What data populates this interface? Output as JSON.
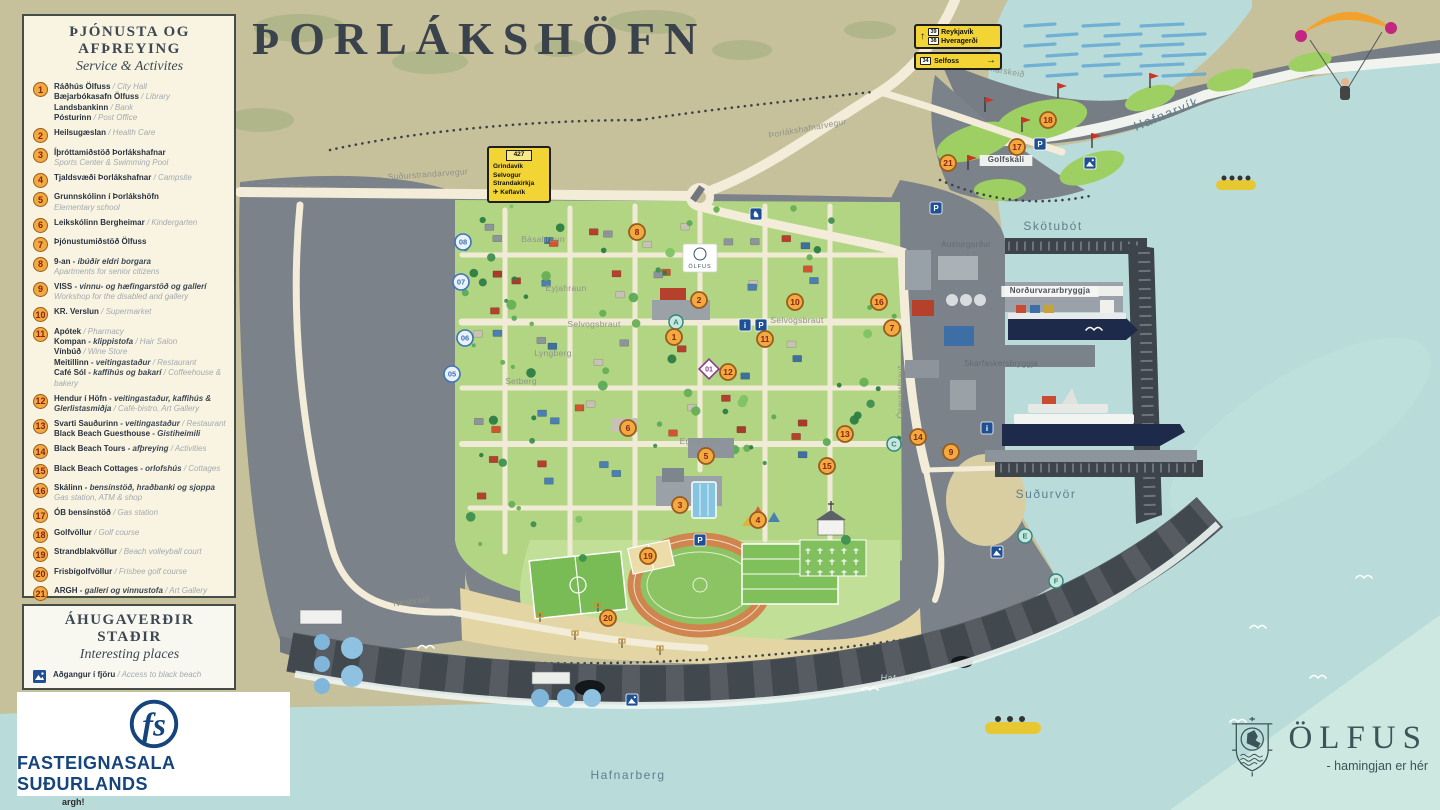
{
  "title": "ÞORLÁKSHÖFN",
  "credit": "argh!",
  "services_legend": {
    "title": "ÞJÓNUSTA OG AFÞREYING",
    "subtitle": "Service & Activites",
    "items": [
      {
        "num": 1,
        "lines": [
          [
            [
              "b",
              "Ráðhús Ölfuss"
            ],
            [
              "g",
              " / City Hall"
            ]
          ],
          [
            [
              "b",
              "Bæjarbókasafn Ölfuss"
            ],
            [
              "g",
              " / Library"
            ]
          ],
          [
            [
              "b",
              "Landsbankinn"
            ],
            [
              "g",
              " / Bank"
            ]
          ],
          [
            [
              "b",
              "Pósturinn"
            ],
            [
              "g",
              " / Post Office"
            ]
          ]
        ]
      },
      {
        "num": 2,
        "lines": [
          [
            [
              "b",
              "Heilsugæslan"
            ],
            [
              "g",
              " / Health Care"
            ]
          ]
        ]
      },
      {
        "num": 3,
        "lines": [
          [
            [
              "b",
              "Íþróttamiðstöð Þorlákshafnar"
            ]
          ],
          [
            [
              "g",
              "Sports Center & Swimming Pool"
            ]
          ]
        ]
      },
      {
        "num": 4,
        "lines": [
          [
            [
              "b",
              "Tjaldsvæði Þorlákshafnar"
            ],
            [
              "g",
              " / Campsite"
            ]
          ]
        ]
      },
      {
        "num": 5,
        "lines": [
          [
            [
              "b",
              "Grunnskólinn í Þorlákshöfn"
            ]
          ],
          [
            [
              "g",
              "Elementary school"
            ]
          ]
        ]
      },
      {
        "num": 6,
        "lines": [
          [
            [
              "b",
              "Leikskólinn Bergheimar"
            ],
            [
              "g",
              " / Kindergarten"
            ]
          ]
        ]
      },
      {
        "num": 7,
        "lines": [
          [
            [
              "b",
              "Þjónustumiðstöð Ölfuss"
            ]
          ]
        ]
      },
      {
        "num": 8,
        "lines": [
          [
            [
              "b",
              "9-an"
            ],
            [
              "i",
              " - íbúðir eldri borgara"
            ]
          ],
          [
            [
              "g",
              "Apartments for senior citizens"
            ]
          ]
        ]
      },
      {
        "num": 9,
        "lines": [
          [
            [
              "b",
              "VISS"
            ],
            [
              "i",
              " - vinnu- og hæfingarstöð og gallerí"
            ],
            [
              "g",
              " Workshop for the disabled and gallery"
            ]
          ]
        ]
      },
      {
        "num": 10,
        "lines": [
          [
            [
              "b",
              "KR. Verslun"
            ],
            [
              "g",
              " / Supermarket"
            ]
          ]
        ]
      },
      {
        "num": 11,
        "lines": [
          [
            [
              "b",
              "Apótek"
            ],
            [
              "g",
              " / Pharmacy"
            ]
          ],
          [
            [
              "b",
              "Kompan"
            ],
            [
              "i",
              " - klippistofa"
            ],
            [
              "g",
              " / Hair Salon"
            ]
          ],
          [
            [
              "b",
              "Vínbúð"
            ],
            [
              "g",
              " / Wine Store"
            ]
          ],
          [
            [
              "b",
              "Meitillinn"
            ],
            [
              "i",
              " - veitingastaður"
            ],
            [
              "g",
              " / Restaurant"
            ]
          ],
          [
            [
              "b",
              "Café Sól"
            ],
            [
              "i",
              " - kaffihús og bakarí"
            ],
            [
              "g",
              " / Coffeehouse & bakery"
            ]
          ]
        ]
      },
      {
        "num": 12,
        "lines": [
          [
            [
              "b",
              "Hendur í Höfn"
            ],
            [
              "i",
              " - veitingastaður, kaffihús & Glerlistasmiðja"
            ],
            [
              "g",
              " / Café-bistro, Art Gallery"
            ]
          ]
        ]
      },
      {
        "num": 13,
        "lines": [
          [
            [
              "b",
              "Svarti Sauðurinn"
            ],
            [
              "i",
              " - veitingastaður"
            ],
            [
              "g",
              " / Restaurant"
            ]
          ],
          [
            [
              "b",
              "Black Beach Guesthouse"
            ],
            [
              "i",
              " - Gistiheimili"
            ]
          ]
        ]
      },
      {
        "num": 14,
        "lines": [
          [
            [
              "b",
              "Black Beach Tours"
            ],
            [
              "i",
              " - afþreying"
            ],
            [
              "g",
              " / Activities"
            ]
          ]
        ]
      },
      {
        "num": 15,
        "lines": [
          [
            [
              "b",
              "Black Beach Cottages"
            ],
            [
              "i",
              " - orlofshús"
            ],
            [
              "g",
              " / Cottages"
            ]
          ]
        ]
      },
      {
        "num": 16,
        "lines": [
          [
            [
              "b",
              "Skálinn"
            ],
            [
              "i",
              " - bensínstöð, hraðbanki og sjoppa"
            ]
          ],
          [
            [
              "g",
              "Gas station, ATM & shop"
            ]
          ]
        ]
      },
      {
        "num": 17,
        "lines": [
          [
            [
              "b",
              "ÓB bensínstöð"
            ],
            [
              "g",
              " / Gas station"
            ]
          ]
        ]
      },
      {
        "num": 18,
        "lines": [
          [
            [
              "b",
              "Golfvöllur"
            ],
            [
              "g",
              " / Golf course"
            ]
          ]
        ]
      },
      {
        "num": 19,
        "lines": [
          [
            [
              "b",
              "Strandblakvöllur"
            ],
            [
              "g",
              " / Beach volleyball court"
            ]
          ]
        ]
      },
      {
        "num": 20,
        "lines": [
          [
            [
              "b",
              "Frisbígolfvöllur"
            ],
            [
              "g",
              " / Frisbee golf course"
            ]
          ]
        ]
      },
      {
        "num": 21,
        "lines": [
          [
            [
              "b",
              "ARGH"
            ],
            [
              "i",
              " - gallerí og vinnustofa"
            ],
            [
              "g",
              " / Art Gallery"
            ]
          ]
        ]
      }
    ]
  },
  "places_legend": {
    "title": "ÁHUGAVERÐIR STAÐIR",
    "subtitle": "Interesting places",
    "items": [
      {
        "icon": "photo-icon",
        "lines": [
          [
            [
              "b",
              "Aðgangur í fjöru"
            ],
            [
              "g",
              " / Access to black beach"
            ]
          ]
        ]
      },
      {
        "icon": "photo-icon",
        "lines": [
          [
            [
              "b",
              "Útsýnisskífa"
            ],
            [
              "g",
              " / Viewpoint"
            ]
          ]
        ]
      }
    ]
  },
  "fs_logo": {
    "monogram": "fs",
    "name": "FASTEIGNASALA SUÐURLANDS"
  },
  "olfus_logo": {
    "name": "ÖLFUS",
    "tagline": "- hamingjan er hér"
  },
  "road_signs": {
    "junction": {
      "route": "427",
      "destinations": [
        "Grindavík",
        "Selvogur",
        "Strandakirkja",
        "✈ Keflavík"
      ]
    },
    "north_a": {
      "arrow": "↑",
      "rows": [
        {
          "badge": "39",
          "text": "Reykjavík"
        },
        {
          "badge": "38",
          "text": "Hveragerði"
        }
      ]
    },
    "north_b": {
      "badge": "34",
      "text": "Selfoss",
      "arrow": "→"
    }
  },
  "map_banner": {
    "text": "ÖLFUS",
    "x": 700,
    "y": 258
  },
  "map_labels": [
    {
      "t": "Hafnarvík",
      "x": 1168,
      "y": 118,
      "r": -22,
      "c": "water",
      "fs": 13
    },
    {
      "t": "Skötubót",
      "x": 1053,
      "y": 230,
      "r": 0,
      "c": "water",
      "fs": 12
    },
    {
      "t": "Suðurvör",
      "x": 1046,
      "y": 498,
      "r": 0,
      "c": "water",
      "fs": 12
    },
    {
      "t": "Hafnarberg",
      "x": 628,
      "y": 779,
      "r": 0,
      "c": "water",
      "fs": 12
    },
    {
      "t": "Hafnarnes",
      "x": 903,
      "y": 682,
      "r": 4,
      "c": "cliff",
      "fs": 9
    },
    {
      "t": "Austurgarður",
      "x": 966,
      "y": 247,
      "r": 0,
      "c": "small",
      "fs": 8
    },
    {
      "t": "Norðurvararbryggja",
      "x": 1050,
      "y": 293,
      "r": 0,
      "c": "pier",
      "fs": 8
    },
    {
      "t": "Skarfaskersbryggja",
      "x": 1001,
      "y": 366,
      "r": 0,
      "c": "small",
      "fs": 8
    },
    {
      "t": "Golfskáli",
      "x": 1006,
      "y": 162,
      "r": 0,
      "c": "pier",
      "fs": 8
    },
    {
      "t": "Þorlákshafnarvegur",
      "x": 808,
      "y": 131,
      "r": -10,
      "c": "road",
      "fs": 8.5
    },
    {
      "t": "Suðurstrandarvegur",
      "x": 428,
      "y": 177,
      "r": -4,
      "c": "road",
      "fs": 8.5
    },
    {
      "t": "Hafnarskeið",
      "x": 1000,
      "y": 73,
      "r": 10,
      "c": "road",
      "fs": 8.5
    },
    {
      "t": "Nesbraut",
      "x": 412,
      "y": 604,
      "r": -8,
      "c": "road",
      "fs": 8.5
    },
    {
      "t": "Selvogsbraut",
      "x": 594,
      "y": 327,
      "r": 0,
      "c": "road",
      "fs": 8.5
    },
    {
      "t": "Selvogsbraut",
      "x": 797,
      "y": 323,
      "r": 0,
      "c": "road",
      "fs": 8.5
    },
    {
      "t": "Óseyrarbraut",
      "x": 903,
      "y": 392,
      "r": -90,
      "c": "road",
      "fs": 8.5
    },
    {
      "t": "Básahraun",
      "x": 543,
      "y": 242,
      "r": 0,
      "c": "road",
      "fs": 8.5
    },
    {
      "t": "Eyjahraun",
      "x": 566,
      "y": 291,
      "r": 0,
      "c": "road",
      "fs": 8.5
    },
    {
      "t": "Lyngberg",
      "x": 553,
      "y": 356,
      "r": 0,
      "c": "road",
      "fs": 8.5
    },
    {
      "t": "Setberg",
      "x": 521,
      "y": 384,
      "r": 0,
      "c": "road",
      "fs": 8.5
    },
    {
      "t": "Egilsbraut",
      "x": 700,
      "y": 444,
      "r": 0,
      "c": "road",
      "fs": 8.5
    }
  ],
  "markers": [
    {
      "n": 1,
      "x": 674,
      "y": 337
    },
    {
      "n": 2,
      "x": 699,
      "y": 300
    },
    {
      "n": 3,
      "x": 680,
      "y": 505
    },
    {
      "n": 4,
      "x": 758,
      "y": 520
    },
    {
      "n": 5,
      "x": 706,
      "y": 456
    },
    {
      "n": 6,
      "x": 628,
      "y": 428
    },
    {
      "n": 7,
      "x": 892,
      "y": 328
    },
    {
      "n": 8,
      "x": 637,
      "y": 232
    },
    {
      "n": 9,
      "x": 951,
      "y": 452
    },
    {
      "n": 10,
      "x": 795,
      "y": 302
    },
    {
      "n": 11,
      "x": 765,
      "y": 339
    },
    {
      "n": 12,
      "x": 728,
      "y": 372
    },
    {
      "n": 13,
      "x": 845,
      "y": 434
    },
    {
      "n": 14,
      "x": 918,
      "y": 437
    },
    {
      "n": 15,
      "x": 827,
      "y": 466
    },
    {
      "n": 16,
      "x": 879,
      "y": 302
    },
    {
      "n": 17,
      "x": 1017,
      "y": 147
    },
    {
      "n": 18,
      "x": 1048,
      "y": 120
    },
    {
      "n": 19,
      "x": 648,
      "y": 556
    },
    {
      "n": 20,
      "x": 608,
      "y": 618
    },
    {
      "n": 21,
      "x": 948,
      "y": 163
    }
  ],
  "route_stops": [
    {
      "n": "05",
      "x": 452,
      "y": 374
    },
    {
      "n": "06",
      "x": 465,
      "y": 338
    },
    {
      "n": "07",
      "x": 461,
      "y": 282
    },
    {
      "n": "08",
      "x": 463,
      "y": 242
    }
  ],
  "trail_markers": [
    {
      "n": "01",
      "x": 709,
      "y": 369
    }
  ],
  "letter_markers": [
    {
      "l": "A",
      "x": 676,
      "y": 322
    },
    {
      "l": "C",
      "x": 894,
      "y": 444
    },
    {
      "l": "E",
      "x": 1025,
      "y": 536
    },
    {
      "l": "F",
      "x": 1056,
      "y": 581
    }
  ],
  "info_icons": [
    {
      "g": "i",
      "x": 745,
      "y": 325
    },
    {
      "g": "P",
      "x": 761,
      "y": 325
    },
    {
      "g": "P",
      "x": 936,
      "y": 208
    },
    {
      "g": "i",
      "x": 987,
      "y": 428
    },
    {
      "g": "P",
      "x": 700,
      "y": 540
    },
    {
      "g": "P",
      "x": 1040,
      "y": 144
    },
    {
      "g": "♞",
      "x": 756,
      "y": 214
    }
  ],
  "photo_spots": [
    {
      "x": 632,
      "y": 700
    },
    {
      "x": 1090,
      "y": 163
    },
    {
      "x": 997,
      "y": 552
    }
  ]
}
